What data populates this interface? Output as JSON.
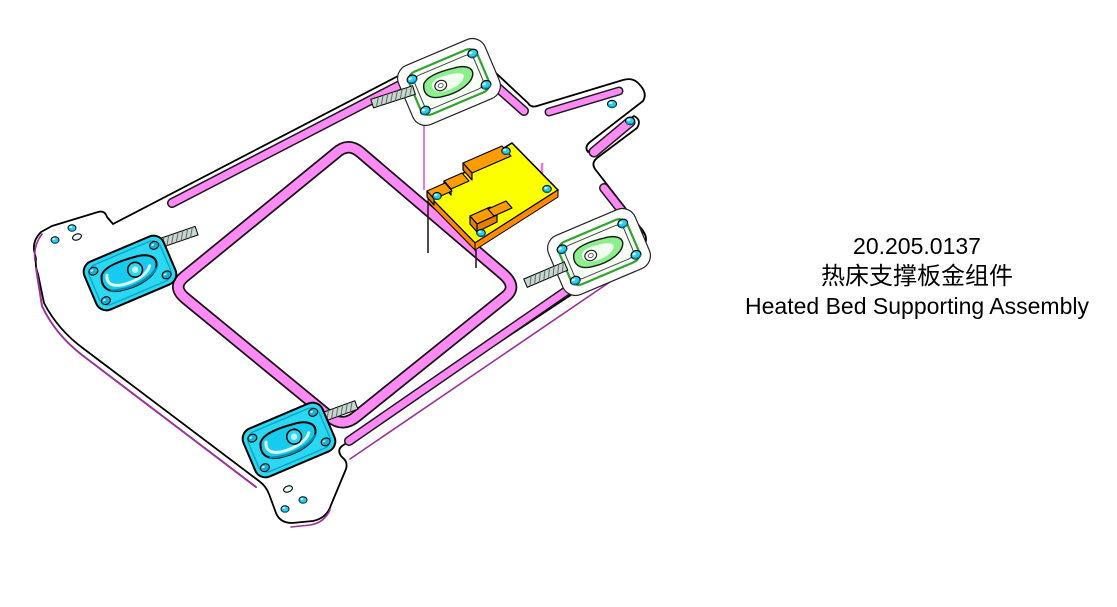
{
  "label": {
    "part_number": "20.205.0137",
    "name_zh": "热床支撑板金组件",
    "name_en": "Heated Bed Supporting Assembly"
  },
  "colors": {
    "background": "#ffffff",
    "outline": "#000000",
    "flange_magenta": "#ff8af5",
    "edge_purple": "#993399",
    "tensioner_cyan": "#2bd8f2",
    "holder_green": "#2fa32f",
    "pcb_yellow": "#fbff00",
    "connector_orange": "#ff9d00",
    "screw_cyan": "#29cff0"
  },
  "icons": {
    "screw": "cyan-dome-screw",
    "oval_hole": "slotted-hole",
    "threaded_rod": "hatched-rod"
  },
  "parts": [
    "base-plate",
    "center-cutout-flange",
    "belt-holder-top",
    "belt-holder-right",
    "belt-tensioner-left",
    "belt-tensioner-bottom",
    "pcb-board",
    "corner-ear-left",
    "corner-ear-bottom",
    "corner-ear-top-right"
  ]
}
